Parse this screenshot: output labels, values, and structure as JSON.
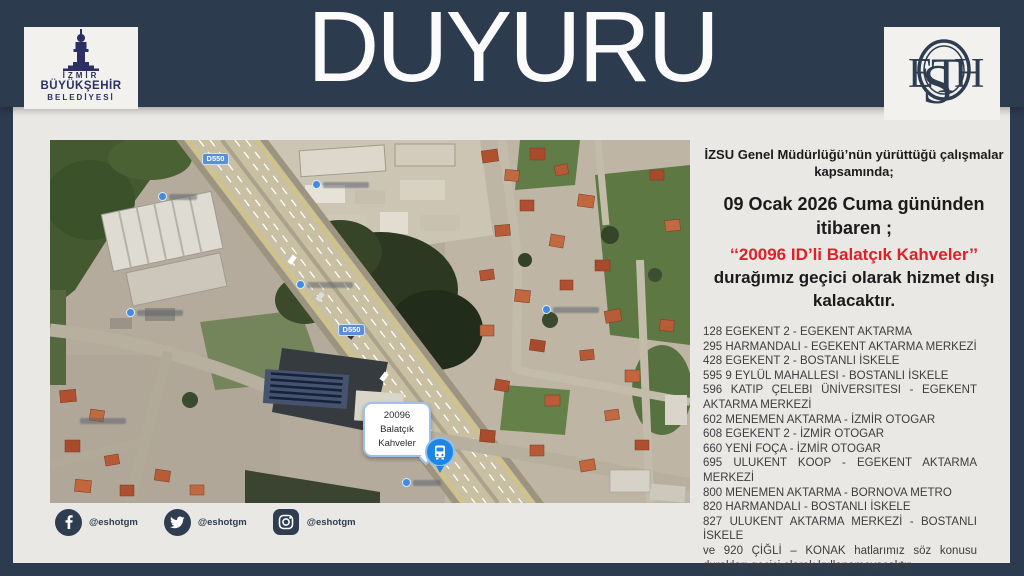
{
  "colors": {
    "banner_navy": "#2d3b4e",
    "background_gray": "#e9e8e4",
    "highlight_red": "#e01f26",
    "marker_blue": "#1d86e5",
    "logo_navy": "#2b2f63"
  },
  "header": {
    "title": "DUYURU",
    "municipality_logo": {
      "line1": "İZMİR",
      "line2": "BÜYÜKŞEHİR",
      "line3": "BELEDİYESİ"
    },
    "eshot_monogram": {
      "s": "S",
      "e": "E",
      "t": "T",
      "h": "H"
    }
  },
  "map": {
    "road_shield_label": "D550",
    "stop_callout": {
      "stop_id": "20096",
      "name_line1": "Balatçık",
      "name_line2": "Kahveler"
    }
  },
  "announcement": {
    "intro": "İZSU Genel Müdürlüğü’nün yürüttüğü çalışmalar kapsamında;",
    "date_line": "09 Ocak 2026 Cuma gününden itibaren ;",
    "highlight": "‘‘20096 ID’li Balatçık Kahveler’’",
    "effect": "durağımız geçici olarak hizmet dışı kalacaktır.",
    "routes": [
      "128 EGEKENT 2 - EGEKENT AKTARMA",
      "295 HARMANDALI - EGEKENT AKTARMA MERKEZİ",
      "428 EGEKENT 2 - BOSTANLI İSKELE",
      "595 9 EYLÜL MAHALLESI - BOSTANLI İSKELE",
      "596 KATIP ÇELEBI ÜNİVERSITESI - EGEKENT AKTARMA MERKEZİ",
      "602 MENEMEN AKTARMA - İZMİR OTOGAR",
      "608 EGEKENT 2 - İZMİR OTOGAR",
      "660 YENİ FOÇA - İZMİR OTOGAR",
      "695 ULUKENT KOOP - EGEKENT AKTARMA MERKEZİ",
      "800 MENEMEN AKTARMA - BORNOVA METRO",
      "820 HARMANDALI - BOSTANLI İSKELE",
      "827 ULUKENT AKTARMA MERKEZİ - BOSTANLI İSKELE"
    ],
    "closing": "ve 920 ÇİĞLİ – KONAK hatlarımız söz konusu durakları geçici olarak kullanamayacaktır."
  },
  "social": {
    "facebook_handle": "@eshotgm",
    "twitter_handle": "@eshotgm",
    "instagram_handle": "@eshotgm"
  }
}
